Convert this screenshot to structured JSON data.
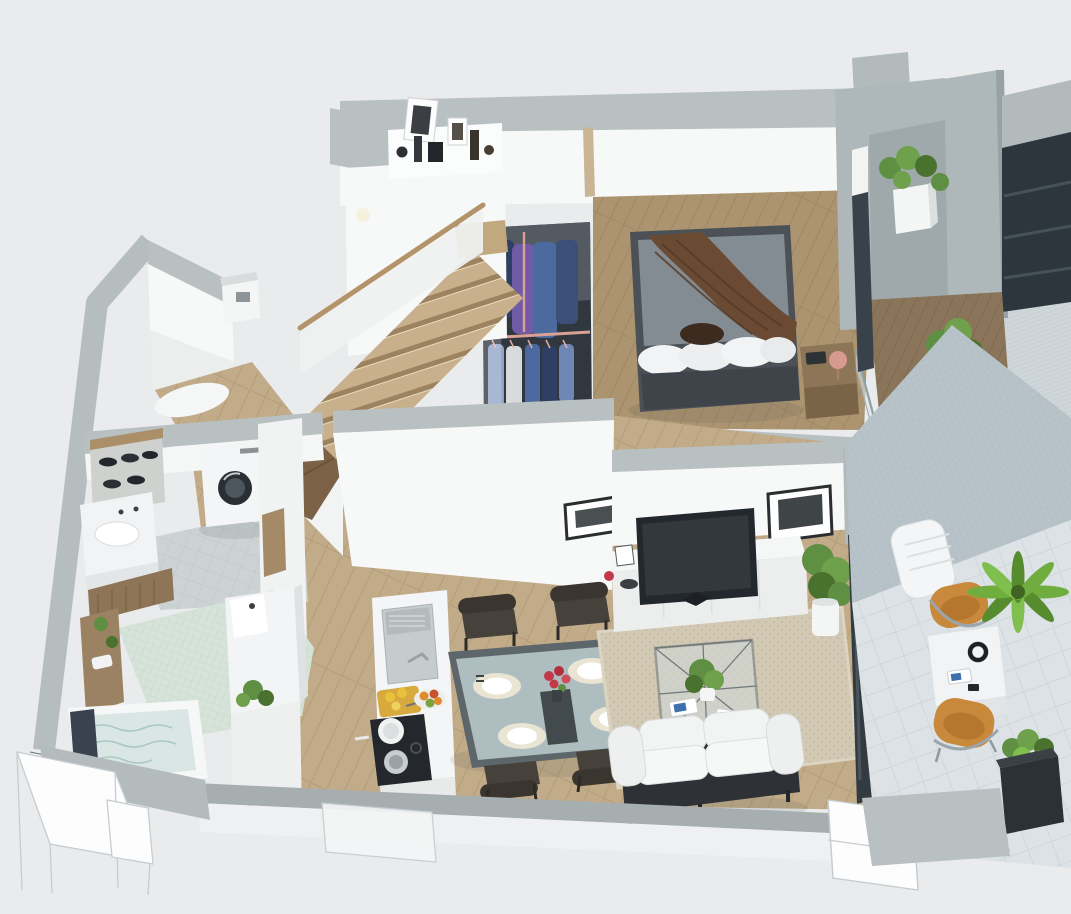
{
  "scene": {
    "description": "3D isometric cutaway floor plan render of a modern duplex apartment viewed from above",
    "render_style": "photorealistic architectural dollhouse cutaway",
    "palette": {
      "bg": "#e9ebec",
      "wall_top": "#b9c0c2",
      "wall_face": "#f7f8f8",
      "wall_shade": "#e3e6e7",
      "concrete": "#aeb7b9",
      "wood_floor": "#c1ab88",
      "wood_line": "#ad9671",
      "wood_floor_bedroom": "#ab946f",
      "wood_bedroom_line": "#96805d",
      "deck": "#8a745a",
      "deck_line": "#756249",
      "stair_wood": "#c7b08b",
      "stair_riser": "#9d8260",
      "handrail_wood": "#b3946a",
      "tile_gray": "#cdd3d4",
      "tile_gray_line": "#bec5c6",
      "mosaic_green": "#d6e3d8",
      "mosaic_line": "#c4d6c8",
      "terrace_tile": "#dce2e5",
      "terrace_tile_line": "#c8d1d5",
      "terrace_wall": "#b7c2c9",
      "terrace_wall_line": "#abb7be",
      "hatch": "#cfd6d9",
      "hatch_line": "#c1c9cc",
      "glass_dark": "#2d363d",
      "glass_pane": "#dde8ea",
      "bed_frame": "#4b5157",
      "duvet": "#848c93",
      "blanket_brown": "#6b4a33",
      "blanket_fold": "#553a27",
      "pillow_white": "#f2f3f4",
      "pillow_brown": "#3d2b20",
      "wood_furniture": "#8d7557",
      "lamp_pink": "#d89a8e",
      "sofa_white": "#f2f3f3",
      "sofa_base": "#2e3236",
      "rug": "#d2c9b4",
      "rug_dot": "#c5bba3",
      "chair_dining": "#3a352f",
      "chair_tan": "#c8893c",
      "chair_tan_dark": "#b5762e",
      "table_frame": "#5d666b",
      "table_glass": "#b7c6c9",
      "placemat": "#eae4d2",
      "runner_dark": "#434a4e",
      "flower_red": "#c23a4a",
      "plant_green": "#6fa04c",
      "plant_mid": "#5f8f43",
      "plant_dark": "#49722f",
      "palm_green": "#6fae3e",
      "pot_white": "#f4f5f5",
      "planter_dark": "#2b3134",
      "appliance_dark": "#23282e",
      "cooktop_black": "#24282c",
      "rail_pink": "#dba196",
      "clothes_navy": "#2e3f63",
      "clothes_blue": "#4a6aa0",
      "clothes_purple": "#6f5ba6",
      "clothes_lightblue": "#8fa3c8",
      "water": "#d9e6e4",
      "water_line": "#a9c8c2",
      "fruit_yellow": "#e8c23a",
      "fruit_orange": "#e08b2d",
      "board_yellow": "#d8a93c",
      "wireframe": "#c6cdd1"
    },
    "rooms": [
      {
        "name": "Staircase",
        "items": [
          "wooden stair flight",
          "white balustrade",
          "wood handrail",
          "display shelf with framed pictures and ornaments",
          "wall light"
        ]
      },
      {
        "name": "Entry Hall",
        "items": [
          "white wardrobe",
          "bench",
          "wood floor",
          "open door"
        ]
      },
      {
        "name": "Walk-in Closet",
        "items": [
          "clothes hanging on pink rails",
          "blue and purple garments"
        ]
      },
      {
        "name": "Bedroom",
        "items": [
          "double bed with gray duvet",
          "brown throw blanket",
          "white pillows",
          "dark accent pillow",
          "wooden nightstand",
          "table lamp",
          "book"
        ]
      },
      {
        "name": "Bedroom Balcony",
        "items": [
          "dark wood deck",
          "glass railing",
          "white cube planter",
          "potted shrub",
          "concrete parapet"
        ]
      },
      {
        "name": "Laundry Bathroom",
        "items": [
          "washing machine",
          "vanity with sink",
          "shoe shelf with shoes",
          "gray tile floor"
        ]
      },
      {
        "name": "Main Bathroom",
        "items": [
          "bathtub filled with water",
          "dark towel",
          "green mosaic tile floor",
          "wooden vanity with plants",
          "shower and WC column",
          "potted plant"
        ]
      },
      {
        "name": "Kitchen",
        "items": [
          "island with sink and drying rack",
          "faucet",
          "cutting board with lemons",
          "fruit bowl",
          "black cooktop with two pots"
        ]
      },
      {
        "name": "Dining Area",
        "items": [
          "glass dining table",
          "four place settings",
          "red flower centerpiece",
          "dark table runner",
          "four dark wood chairs"
        ]
      },
      {
        "name": "Living Room",
        "items": [
          "white sofa on dark wood base",
          "glass coffee table with plant and magazines",
          "beige area rug",
          "white media console",
          "flat screen TV",
          "two framed artworks",
          "small frame and red vase",
          "potted plant"
        ]
      },
      {
        "name": "Terrace",
        "items": [
          "large tile floor",
          "blue-gray tiled feature wall",
          "white sun lounger",
          "white side table with headphones and magazines",
          "two tan sling chairs",
          "palm plant",
          "dark planter box",
          "glass balustrade"
        ]
      },
      {
        "name": "Exterior",
        "items": [
          "concrete walls",
          "dark glazing",
          "stone textured walkway",
          "foundation wireframe blocks"
        ]
      }
    ]
  }
}
